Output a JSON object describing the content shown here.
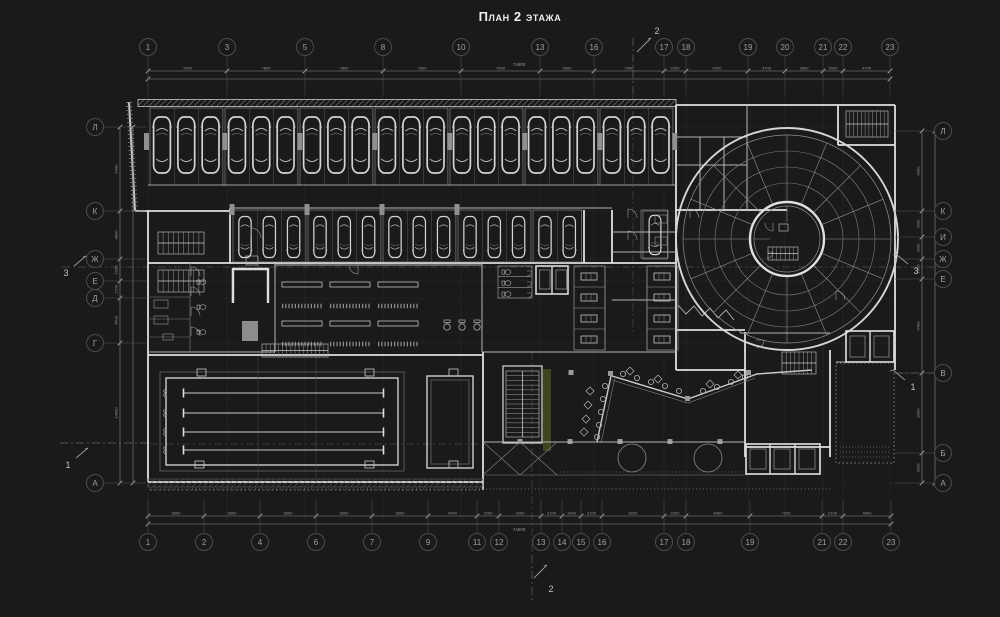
{
  "title": "План 2 этажа",
  "colors": {
    "background": "#1a1a1a",
    "wall_bright": "#e2e2e2",
    "wall_medium": "#b4b4b4",
    "line_thin": "#7d7d7d",
    "line_faint": "#4a4a4a",
    "bubble_stroke": "#4c4c4c",
    "bubble_text": "#a89e96",
    "dim_text": "#969696",
    "accent_green": "#3e451f"
  },
  "grid": {
    "top": [
      {
        "label": "1",
        "x": 148
      },
      {
        "label": "3",
        "x": 227
      },
      {
        "label": "5",
        "x": 305
      },
      {
        "label": "8",
        "x": 383
      },
      {
        "label": "10",
        "x": 461
      },
      {
        "label": "13",
        "x": 540
      },
      {
        "label": "16",
        "x": 594
      },
      {
        "label": "17",
        "x": 664
      },
      {
        "label": "18",
        "x": 686
      },
      {
        "label": "19",
        "x": 748
      },
      {
        "label": "20",
        "x": 785
      },
      {
        "label": "21",
        "x": 823
      },
      {
        "label": "22",
        "x": 843
      },
      {
        "label": "23",
        "x": 890
      }
    ],
    "bottom": [
      {
        "label": "1",
        "x": 148
      },
      {
        "label": "2",
        "x": 204
      },
      {
        "label": "4",
        "x": 260
      },
      {
        "label": "6",
        "x": 316
      },
      {
        "label": "7",
        "x": 372
      },
      {
        "label": "9",
        "x": 428
      },
      {
        "label": "11",
        "x": 477
      },
      {
        "label": "12",
        "x": 499
      },
      {
        "label": "13",
        "x": 541
      },
      {
        "label": "14",
        "x": 562
      },
      {
        "label": "15",
        "x": 581
      },
      {
        "label": "16",
        "x": 602
      },
      {
        "label": "17",
        "x": 664
      },
      {
        "label": "18",
        "x": 686
      },
      {
        "label": "19",
        "x": 750
      },
      {
        "label": "21",
        "x": 822
      },
      {
        "label": "22",
        "x": 843
      },
      {
        "label": "23",
        "x": 891
      }
    ],
    "left": [
      {
        "label": "Л",
        "y": 127
      },
      {
        "label": "К",
        "y": 211
      },
      {
        "label": "Ж",
        "y": 259
      },
      {
        "label": "Е",
        "y": 281
      },
      {
        "label": "Д",
        "y": 298
      },
      {
        "label": "Г",
        "y": 343
      },
      {
        "label": "А",
        "y": 483
      }
    ],
    "right": [
      {
        "label": "Л",
        "y": 131
      },
      {
        "label": "К",
        "y": 211
      },
      {
        "label": "И",
        "y": 237
      },
      {
        "label": "Ж",
        "y": 259
      },
      {
        "label": "Е",
        "y": 279
      },
      {
        "label": "В",
        "y": 373
      },
      {
        "label": "Б",
        "y": 453
      },
      {
        "label": "А",
        "y": 483
      }
    ]
  },
  "dimensions": {
    "top_segments": [
      "7900",
      "7800",
      "7800",
      "7800",
      "7900",
      "5400",
      "7000",
      "2200",
      "6200",
      "3700",
      "3800",
      "2000",
      "4700"
    ],
    "top_total": "74600",
    "bottom_segments": [
      "5600",
      "5600",
      "5600",
      "5600",
      "5600",
      "4900",
      "2200",
      "4200",
      "2100",
      "1900",
      "2100",
      "6200",
      "2200",
      "6400",
      "7200",
      "2100",
      "4800"
    ],
    "bottom_total": "74600",
    "left_segments": [
      "8400",
      "4800",
      "2200",
      "1700",
      "4500",
      "14000"
    ],
    "right_segments": [
      "8000",
      "2600",
      "2200",
      "2000",
      "9400",
      "8000",
      "3000"
    ]
  },
  "sections": [
    {
      "label": "2",
      "x": 657,
      "y": 31,
      "side": "top"
    },
    {
      "label": "2",
      "x": 551,
      "y": 589,
      "side": "bottom"
    },
    {
      "label": "3",
      "x": 66,
      "y": 273,
      "side": "left"
    },
    {
      "label": "3",
      "x": 916,
      "y": 271,
      "side": "right"
    },
    {
      "label": "1",
      "x": 68,
      "y": 465,
      "side": "left"
    },
    {
      "label": "1",
      "x": 913,
      "y": 387,
      "side": "right"
    }
  ],
  "plan": {
    "top_row_cars": 21,
    "mid_row_cars": 14,
    "extra_cars": 1,
    "parking_group_size": 3,
    "pool_lanes": 4,
    "ramp_spokes": 16,
    "ramp_rings": 4,
    "locker_columns": 3
  }
}
